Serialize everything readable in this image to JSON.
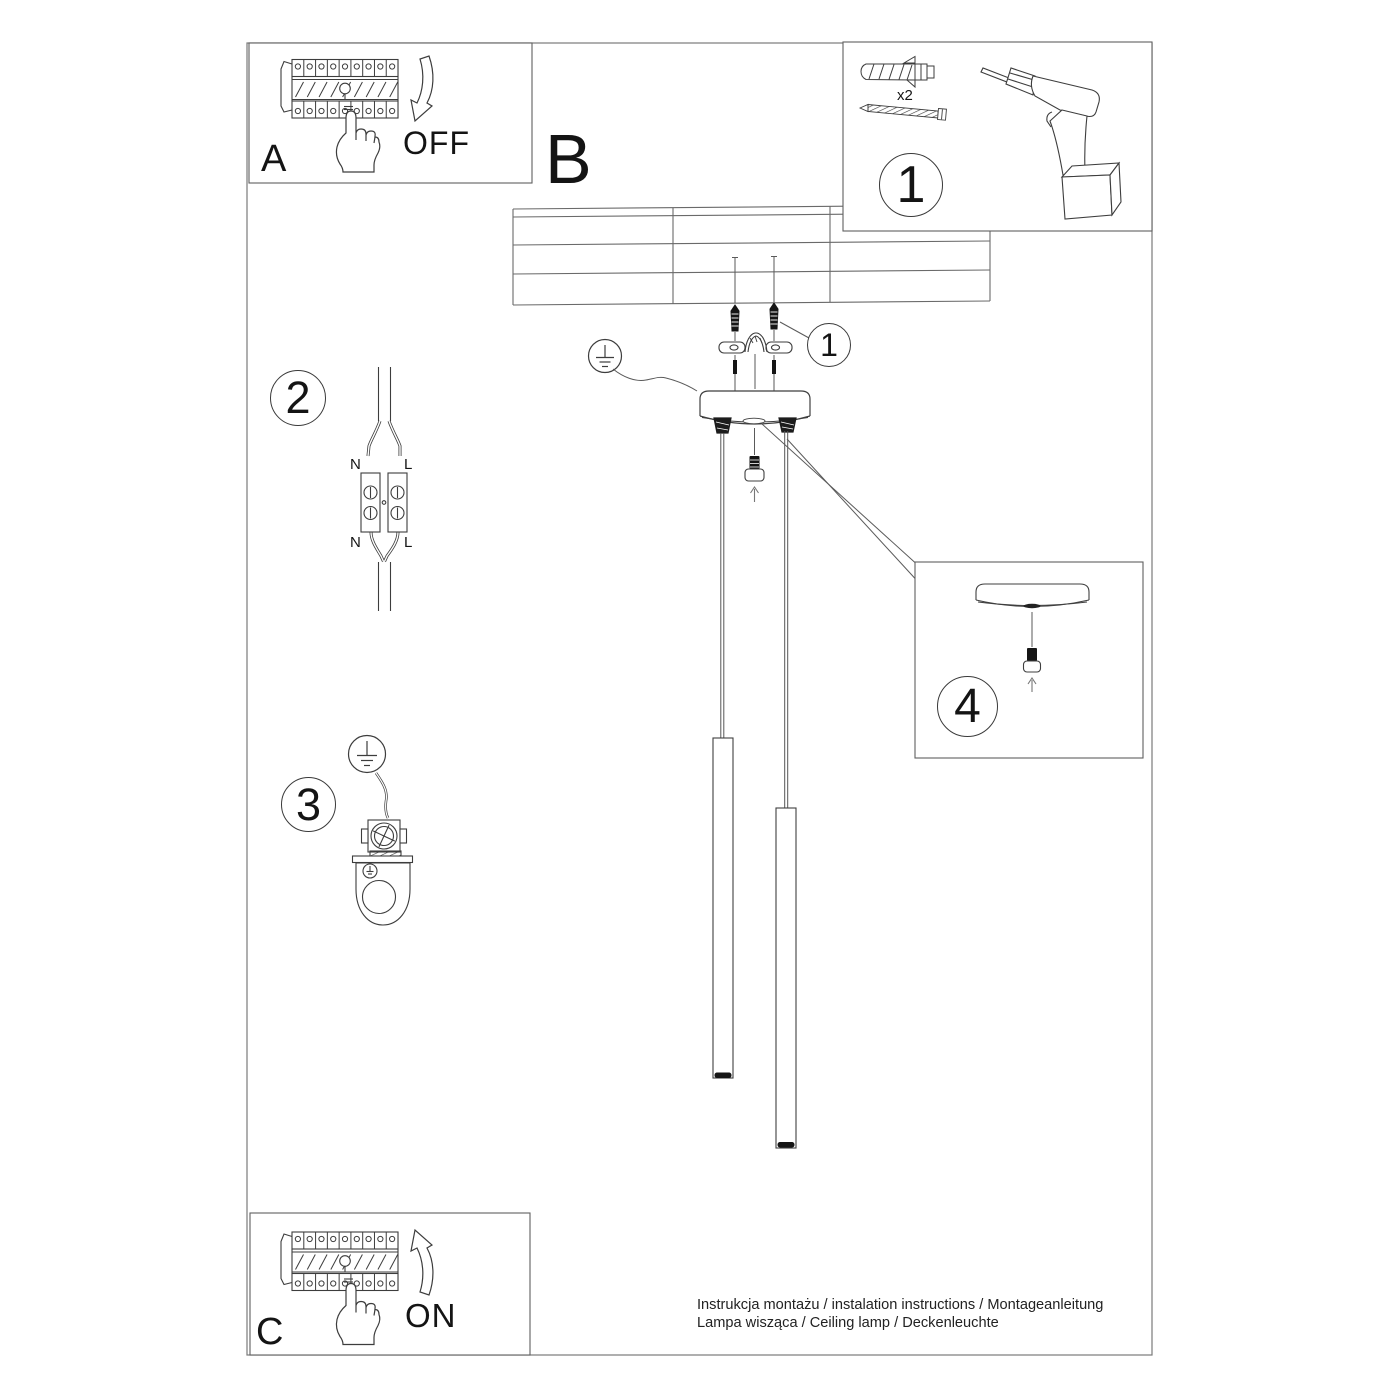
{
  "colors": {
    "line": "#3d3d3d",
    "border": "#6e6e6e",
    "ink": "#141414",
    "background": "#ffffff"
  },
  "sections": {
    "a": {
      "label": "A",
      "state": "OFF"
    },
    "b": {
      "label": "B"
    },
    "c": {
      "label": "C",
      "state": "ON"
    },
    "step1": {
      "number": "1",
      "anchor_count": "x2"
    },
    "screw_callout": {
      "number": "1"
    },
    "step2": {
      "number": "2",
      "terminal_top_left": "N",
      "terminal_top_right": "L",
      "terminal_bottom_left": "N",
      "terminal_bottom_right": "L"
    },
    "step3": {
      "number": "3"
    },
    "step4": {
      "number": "4"
    }
  },
  "footer": {
    "line1": "Instrukcja montażu / instalation instructions / Montageanleitung",
    "line2": "Lampa wisząca / Ceiling lamp / Deckenleuchte"
  }
}
